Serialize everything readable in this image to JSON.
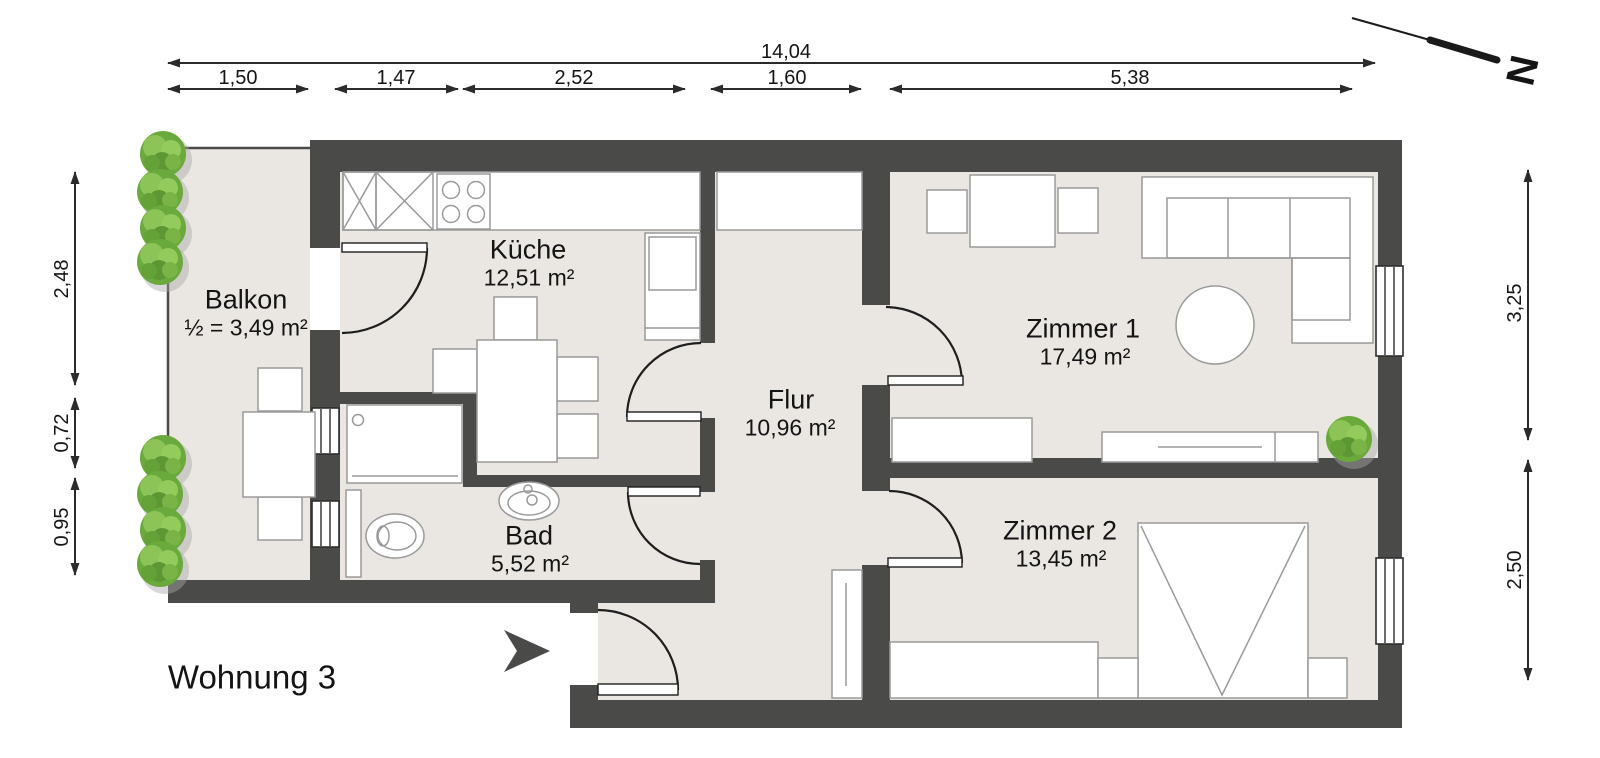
{
  "title": "Wohnung 3",
  "compass": {
    "label": "N"
  },
  "rooms": [
    {
      "name": "Balkon",
      "area": "½ = 3,49 m²"
    },
    {
      "name": "Küche",
      "area": "12,51 m²"
    },
    {
      "name": "Bad",
      "area": "5,52 m²"
    },
    {
      "name": "Flur",
      "area": "10,96 m²"
    },
    {
      "name": "Zimmer 1",
      "area": "17,49 m²"
    },
    {
      "name": "Zimmer 2",
      "area": "13,45 m²"
    }
  ],
  "dimensions": {
    "total_width": "14,04",
    "top_segments": [
      "1,50",
      "1,47",
      "2,52",
      "1,60",
      "5,38"
    ],
    "left_segments": [
      "2,48",
      "0,72",
      "0,95"
    ],
    "right_segments": [
      "3,25",
      "2,50"
    ]
  },
  "symbols": {
    "balkon": [
      "balcony-table",
      "balcony-chairs",
      "shrub-row"
    ],
    "kueche": [
      "kitchen-counter",
      "x-cabinets",
      "stove-4-burners",
      "tall-fridge",
      "dining-table",
      "chairs"
    ],
    "bad": [
      "shower-tray",
      "toilet",
      "washbasin",
      "wall-windows"
    ],
    "flur": [
      "built-in-closet",
      "hall-wardrobe",
      "entrance-door",
      "entrance-arrow"
    ],
    "zimmer1": [
      "desk-with-two-chairs",
      "corner-sofa",
      "round-table",
      "sideboard",
      "lowboard",
      "plant",
      "window"
    ],
    "zimmer2": [
      "double-bed",
      "nightstand-left",
      "nightstand-right",
      "dresser",
      "window"
    ]
  },
  "colors": {
    "wall": "#4a4a48",
    "floor": "#eae7e2",
    "door_line": "#1e1e1e",
    "furniture_stroke": "#9a9a9a",
    "plant_green": "#6aa93c",
    "dimension": "#2b2b2b",
    "text": "#141414"
  }
}
